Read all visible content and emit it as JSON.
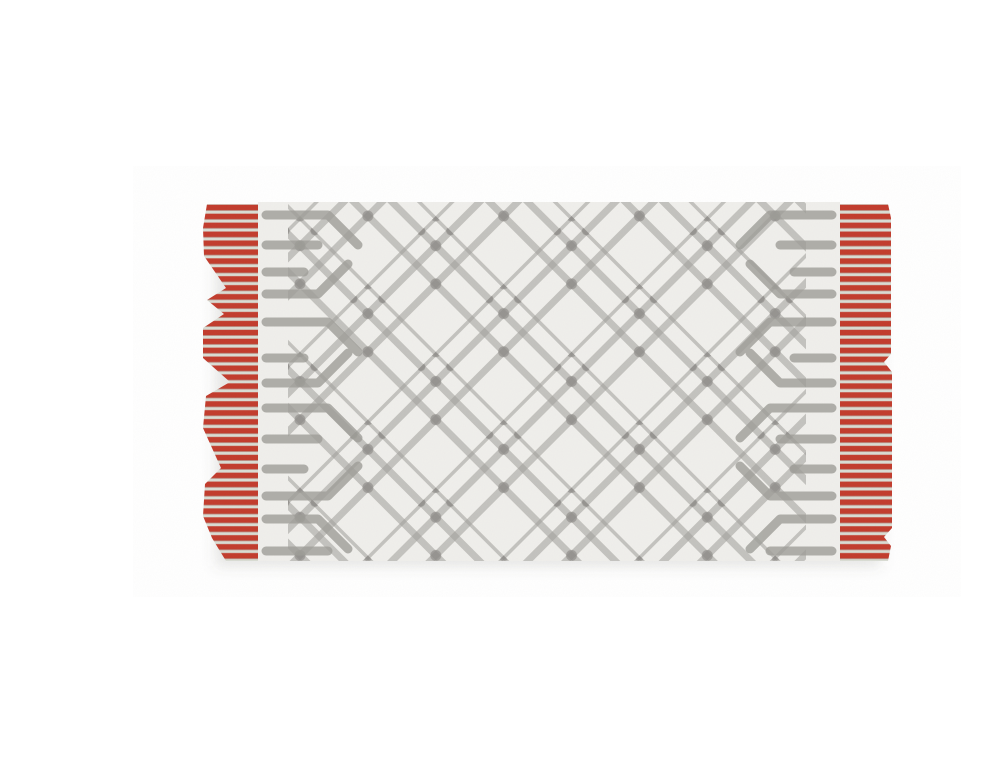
{
  "image": {
    "type": "product-photo",
    "background": "#ffffff",
    "subject": "Flat-weave kilim area rug displayed flat on a plain white background",
    "orientation": "landscape"
  },
  "rug": {
    "description": "Rectangular cream flat-weave rug with an interlocking grey nested-diamond trellis pattern, small knot accents at the line crossings, comb-and-arrow motifs along both short ends, and red striped fringe bands with jagged edges on the left and right sides.",
    "pattern_style": "interlocking nested diamond lattice (kilim trellis)",
    "ends": "horizontal comb dashes with chevron turns",
    "fringe_sides": "left and right, horizontal red stripes",
    "colors": {
      "ground": "#f0efeb",
      "lattice": "#9e9d98",
      "knot": "#7b7a75",
      "fringe_red": "#c23b2c",
      "fringe_red_dark": "#9a2c1f",
      "fringe_gap_light": "#d9dcd3",
      "shadow": "rgba(96,96,90,0.16)"
    }
  }
}
